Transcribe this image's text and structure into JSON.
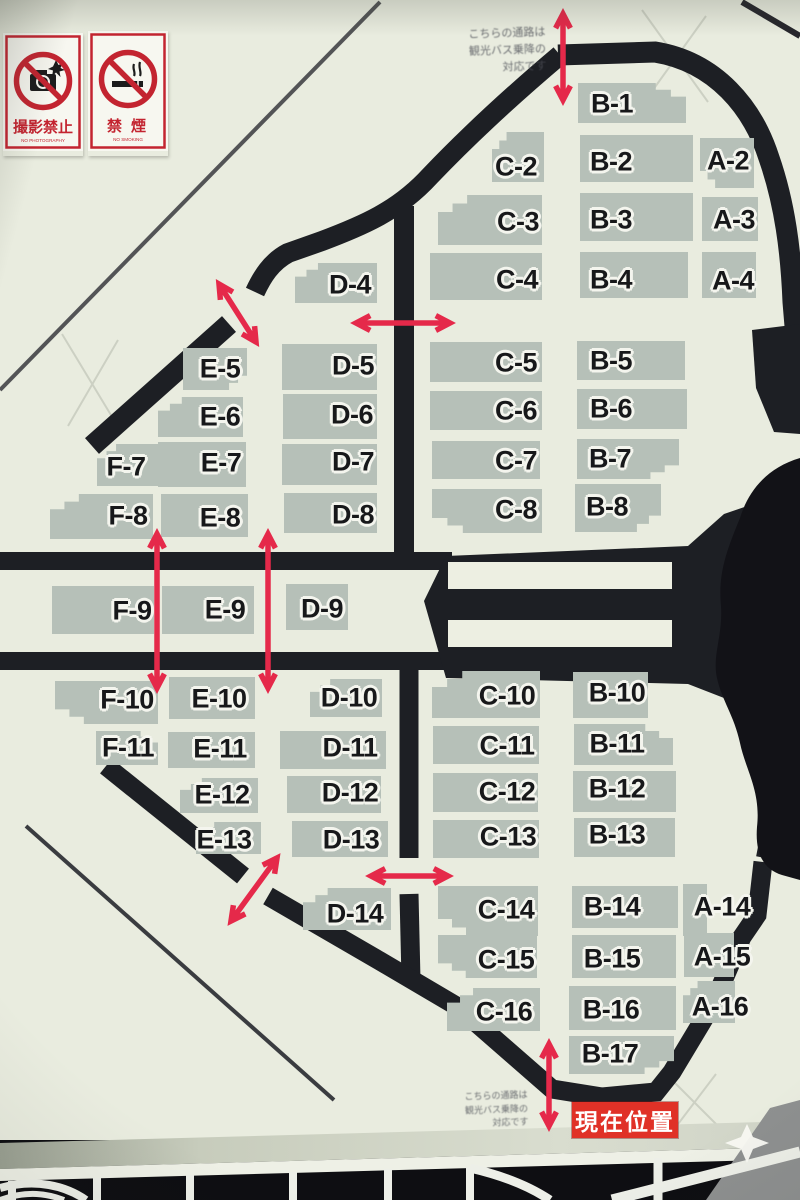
{
  "signs": {
    "no_photo": {
      "title": "撮影禁止",
      "subtitle": "NO PHOTOGRAPHY"
    },
    "no_smoking": {
      "title": "禁煙",
      "subtitle": "NO SMOKING"
    }
  },
  "marker": {
    "label": "現在位置"
  },
  "map": {
    "notes": {
      "top": {
        "lines": [
          "こちらの通路は",
          "観光バス乗降の",
          "対応です"
        ]
      },
      "bottom": {
        "lines": [
          "こちらの通路は",
          "観光バス乗降の",
          "対応です"
        ]
      }
    },
    "blocks": [
      {
        "label": "B-1",
        "rect": [
          578,
          83,
          108,
          40
        ],
        "at": [
          612,
          104
        ],
        "step": "tr"
      },
      {
        "label": "C-2",
        "rect": [
          492,
          132,
          52,
          50
        ],
        "at": [
          516,
          167
        ],
        "step": "tl"
      },
      {
        "label": "B-2",
        "rect": [
          580,
          135,
          113,
          47
        ],
        "at": [
          611,
          162
        ]
      },
      {
        "label": "A-2",
        "rect": [
          700,
          138,
          54,
          50
        ],
        "at": [
          728,
          161
        ],
        "step": "bl"
      },
      {
        "label": "C-3",
        "rect": [
          438,
          195,
          104,
          50
        ],
        "at": [
          518,
          222
        ],
        "step": "tl"
      },
      {
        "label": "B-3",
        "rect": [
          580,
          193,
          113,
          48
        ],
        "at": [
          611,
          220
        ]
      },
      {
        "label": "A-3",
        "rect": [
          702,
          197,
          56,
          44
        ],
        "at": [
          734,
          220
        ]
      },
      {
        "label": "D-4",
        "rect": [
          295,
          263,
          82,
          40
        ],
        "at": [
          350,
          285
        ],
        "step": "tl"
      },
      {
        "label": "C-4",
        "rect": [
          430,
          253,
          112,
          47
        ],
        "at": [
          517,
          280
        ]
      },
      {
        "label": "B-4",
        "rect": [
          580,
          252,
          108,
          46
        ],
        "at": [
          611,
          280
        ]
      },
      {
        "label": "A-4",
        "rect": [
          702,
          252,
          54,
          46
        ],
        "at": [
          733,
          281
        ]
      },
      {
        "label": "E-5",
        "rect": [
          183,
          348,
          64,
          42
        ],
        "at": [
          220,
          369
        ],
        "step": "br"
      },
      {
        "label": "D-5",
        "rect": [
          282,
          344,
          95,
          46
        ],
        "at": [
          353,
          366
        ]
      },
      {
        "label": "C-5",
        "rect": [
          430,
          342,
          112,
          40
        ],
        "at": [
          516,
          363
        ]
      },
      {
        "label": "B-5",
        "rect": [
          577,
          341,
          108,
          39
        ],
        "at": [
          611,
          361
        ]
      },
      {
        "label": "E-6",
        "rect": [
          158,
          397,
          85,
          40
        ],
        "at": [
          220,
          417
        ],
        "step": "tl"
      },
      {
        "label": "D-6",
        "rect": [
          283,
          394,
          94,
          45
        ],
        "at": [
          352,
          415
        ]
      },
      {
        "label": "C-6",
        "rect": [
          430,
          391,
          112,
          39
        ],
        "at": [
          516,
          411
        ]
      },
      {
        "label": "B-6",
        "rect": [
          577,
          389,
          110,
          40
        ],
        "at": [
          611,
          409
        ]
      },
      {
        "label": "F-7",
        "rect": [
          97,
          444,
          68,
          42
        ],
        "at": [
          126,
          467
        ],
        "step": "tl"
      },
      {
        "label": "E-7",
        "rect": [
          158,
          442,
          88,
          45
        ],
        "at": [
          221,
          463
        ]
      },
      {
        "label": "D-7",
        "rect": [
          282,
          444,
          95,
          41
        ],
        "at": [
          353,
          462
        ]
      },
      {
        "label": "C-7",
        "rect": [
          432,
          441,
          108,
          38
        ],
        "at": [
          516,
          461
        ]
      },
      {
        "label": "B-7",
        "rect": [
          577,
          439,
          102,
          40
        ],
        "at": [
          610,
          459
        ],
        "step": "br"
      },
      {
        "label": "F-8",
        "rect": [
          50,
          494,
          103,
          45
        ],
        "at": [
          128,
          516
        ],
        "step": "tl"
      },
      {
        "label": "E-8",
        "rect": [
          161,
          494,
          87,
          43
        ],
        "at": [
          220,
          518
        ]
      },
      {
        "label": "D-8",
        "rect": [
          284,
          493,
          93,
          40
        ],
        "at": [
          353,
          515
        ]
      },
      {
        "label": "C-8",
        "rect": [
          432,
          489,
          110,
          44
        ],
        "at": [
          516,
          510
        ],
        "step": "bl"
      },
      {
        "label": "B-8",
        "rect": [
          575,
          484,
          86,
          48
        ],
        "at": [
          607,
          507
        ],
        "step": "br"
      },
      {
        "label": "F-9",
        "rect": [
          52,
          586,
          102,
          48
        ],
        "at": [
          132,
          611
        ]
      },
      {
        "label": "E-9",
        "rect": [
          162,
          586,
          92,
          48
        ],
        "at": [
          225,
          610
        ]
      },
      {
        "label": "D-9",
        "rect": [
          286,
          584,
          62,
          46
        ],
        "at": [
          322,
          609
        ]
      },
      {
        "label": "F-10",
        "rect": [
          55,
          681,
          103,
          43
        ],
        "at": [
          127,
          700
        ],
        "step": "bl"
      },
      {
        "label": "E-10",
        "rect": [
          169,
          677,
          86,
          42
        ],
        "at": [
          219,
          699
        ]
      },
      {
        "label": "D-10",
        "rect": [
          310,
          679,
          72,
          38
        ],
        "at": [
          349,
          698
        ],
        "step": "tl"
      },
      {
        "label": "C-10",
        "rect": [
          432,
          671,
          108,
          47
        ],
        "at": [
          507,
          696
        ],
        "step": "tl"
      },
      {
        "label": "B-10",
        "rect": [
          573,
          672,
          75,
          46
        ],
        "at": [
          617,
          693
        ]
      },
      {
        "label": "F-11",
        "rect": [
          96,
          731,
          62,
          34
        ],
        "at": [
          128,
          748
        ],
        "step": "tr"
      },
      {
        "label": "E-11",
        "rect": [
          168,
          732,
          87,
          36
        ],
        "at": [
          220,
          749
        ]
      },
      {
        "label": "D-11",
        "rect": [
          280,
          731,
          106,
          38
        ],
        "at": [
          350,
          748
        ]
      },
      {
        "label": "C-11",
        "rect": [
          433,
          726,
          106,
          38
        ],
        "at": [
          507,
          746
        ]
      },
      {
        "label": "B-11",
        "rect": [
          574,
          724,
          99,
          41
        ],
        "at": [
          617,
          744
        ],
        "step": "tr"
      },
      {
        "label": "E-12",
        "rect": [
          180,
          778,
          78,
          35
        ],
        "at": [
          222,
          795
        ],
        "step": "tl"
      },
      {
        "label": "D-12",
        "rect": [
          287,
          776,
          94,
          37
        ],
        "at": [
          350,
          793
        ]
      },
      {
        "label": "C-12",
        "rect": [
          433,
          773,
          105,
          39
        ],
        "at": [
          507,
          792
        ]
      },
      {
        "label": "B-12",
        "rect": [
          573,
          771,
          103,
          41
        ],
        "at": [
          617,
          789
        ]
      },
      {
        "label": "E-13",
        "rect": [
          196,
          822,
          65,
          32
        ],
        "at": [
          224,
          840
        ],
        "step": "tl"
      },
      {
        "label": "D-13",
        "rect": [
          292,
          821,
          96,
          36
        ],
        "at": [
          351,
          840
        ]
      },
      {
        "label": "C-13",
        "rect": [
          433,
          820,
          106,
          38
        ],
        "at": [
          508,
          837
        ]
      },
      {
        "label": "B-13",
        "rect": [
          574,
          818,
          101,
          39
        ],
        "at": [
          617,
          835
        ]
      },
      {
        "label": "D-14",
        "rect": [
          303,
          888,
          88,
          42
        ],
        "at": [
          355,
          914
        ],
        "step": "tl"
      },
      {
        "label": "C-14",
        "rect": [
          438,
          886,
          100,
          50
        ],
        "at": [
          506,
          910
        ],
        "step": "bl"
      },
      {
        "label": "B-14",
        "rect": [
          572,
          886,
          106,
          42
        ],
        "at": [
          612,
          907
        ]
      },
      {
        "label": "A-14",
        "rect": [
          683,
          884,
          24,
          52
        ],
        "at": [
          722,
          907
        ]
      },
      {
        "label": "C-15",
        "rect": [
          438,
          935,
          99,
          43
        ],
        "at": [
          506,
          960
        ],
        "step": "bl"
      },
      {
        "label": "B-15",
        "rect": [
          572,
          935,
          104,
          43
        ],
        "at": [
          612,
          959
        ]
      },
      {
        "label": "A-15",
        "rect": [
          684,
          933,
          50,
          44
        ],
        "at": [
          722,
          957
        ]
      },
      {
        "label": "C-16",
        "rect": [
          447,
          988,
          93,
          43
        ],
        "at": [
          504,
          1012
        ],
        "step": "tl"
      },
      {
        "label": "B-16",
        "rect": [
          569,
          986,
          107,
          44
        ],
        "at": [
          611,
          1010
        ]
      },
      {
        "label": "A-16",
        "rect": [
          683,
          981,
          52,
          42
        ],
        "at": [
          720,
          1007
        ],
        "step": "tl"
      },
      {
        "label": "B-17",
        "rect": [
          569,
          1036,
          105,
          38
        ],
        "at": [
          610,
          1054
        ],
        "step": "br"
      }
    ],
    "arrows": [
      [
        563,
        14,
        563,
        100
      ],
      [
        219,
        284,
        256,
        342
      ],
      [
        356,
        323,
        450,
        323
      ],
      [
        157,
        534,
        157,
        688
      ],
      [
        268,
        534,
        268,
        688
      ],
      [
        277,
        858,
        231,
        921
      ],
      [
        371,
        876,
        448,
        876
      ],
      [
        549,
        1044,
        549,
        1126
      ]
    ]
  },
  "colors": {
    "background": "#e9ecdf",
    "block_fill": "#b6c0b8",
    "road": "#1d1f24",
    "arrow_red": "#e5294a",
    "sign_red": "#c32430",
    "marker_red": "#e03127",
    "label_text": "#17181a",
    "label_outline": "#f4f5ee"
  }
}
